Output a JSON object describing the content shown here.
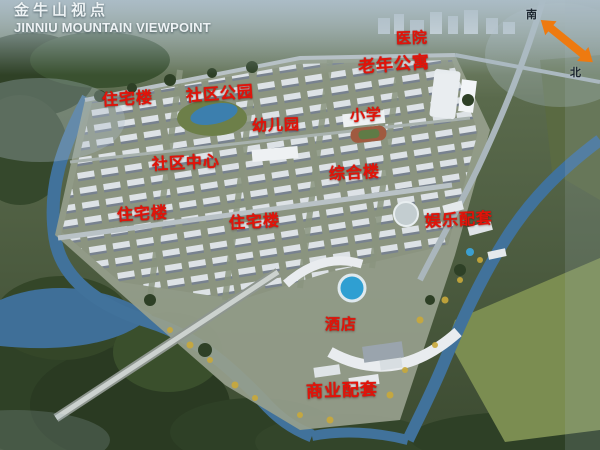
{
  "header": {
    "title_zh": "金牛山视点",
    "title_en": "JINNIU MOUNTAIN VIEWPOINT"
  },
  "compass": {
    "south_label": "南",
    "north_label": "北"
  },
  "map_labels": [
    {
      "id": "hospital",
      "text": "医院"
    },
    {
      "id": "senior-apartments",
      "text": "老年公寓"
    },
    {
      "id": "residential-building-1",
      "text": "住宅楼"
    },
    {
      "id": "community-park",
      "text": "社区公园"
    },
    {
      "id": "kindergarten",
      "text": "幼儿园"
    },
    {
      "id": "primary-school",
      "text": "小学"
    },
    {
      "id": "community-center",
      "text": "社区中心"
    },
    {
      "id": "mixed-use-building",
      "text": "综合楼"
    },
    {
      "id": "residential-building-2",
      "text": "住宅楼"
    },
    {
      "id": "residential-building-3",
      "text": "住宅楼"
    },
    {
      "id": "entertainment-facilities",
      "text": "娱乐配套"
    },
    {
      "id": "hotel",
      "text": "酒店"
    },
    {
      "id": "commercial-facilities",
      "text": "商业配套"
    }
  ],
  "colors": {
    "label_red": "#e21309",
    "arrow_orange": "#ee7a10",
    "title_white": "#eef3f5",
    "water_blue": "#41729b"
  }
}
